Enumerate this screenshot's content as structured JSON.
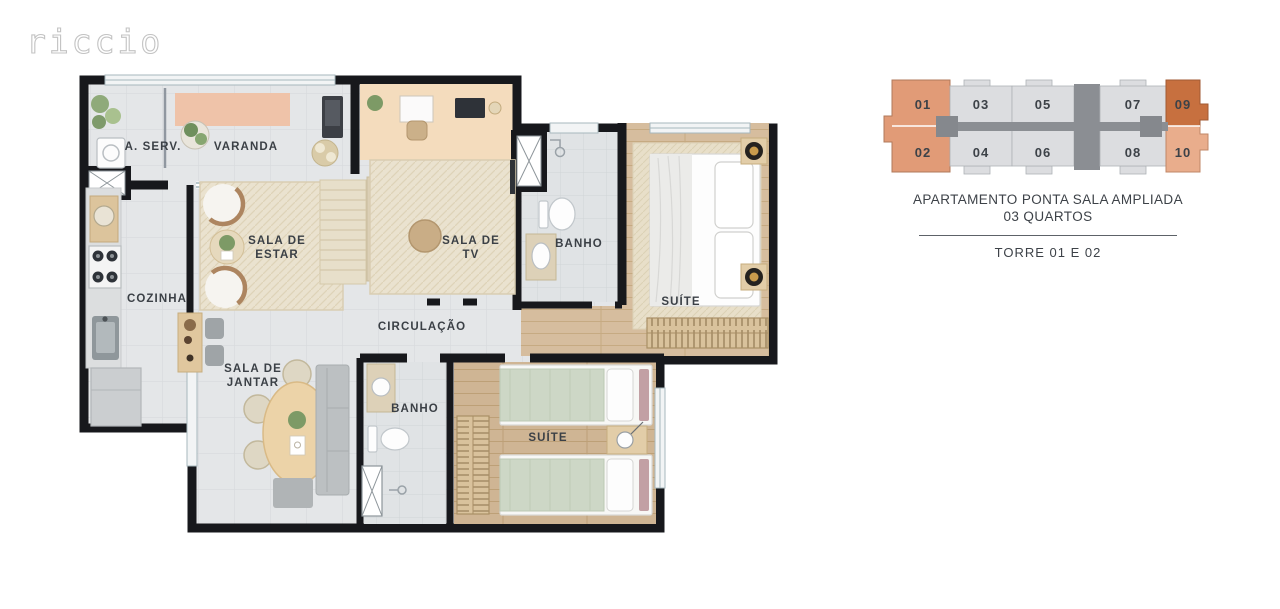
{
  "brand": {
    "logo": "riccio"
  },
  "floorplan": {
    "labels": {
      "a_serv": "A. SERV.",
      "varanda": "VARANDA",
      "sala_estar_l1": "SALA DE",
      "sala_estar_l2": "ESTAR",
      "sala_tv_l1": "SALA DE",
      "sala_tv_l2": "TV",
      "banho1": "BANHO",
      "suite1": "SUÍTE",
      "cozinha": "COZINHA",
      "circulacao": "CIRCULAÇÃO",
      "sala_jantar_l1": "SALA DE",
      "sala_jantar_l2": "JANTAR",
      "banho2": "BANHO",
      "suite2": "SUÍTE"
    }
  },
  "keyplan": {
    "units": [
      {
        "label": "01",
        "color": "#e19b77"
      },
      {
        "label": "02",
        "color": "#e19b77"
      },
      {
        "label": "03",
        "color": "#dcdde0"
      },
      {
        "label": "04",
        "color": "#dcdde0"
      },
      {
        "label": "05",
        "color": "#dcdde0"
      },
      {
        "label": "06",
        "color": "#dcdde0"
      },
      {
        "label": "07",
        "color": "#dcdde0"
      },
      {
        "label": "08",
        "color": "#dcdde0"
      },
      {
        "label": "09",
        "color": "#c7703f"
      },
      {
        "label": "10",
        "color": "#e9ad8c"
      }
    ],
    "caption_line1": "APARTAMENTO PONTA SALA AMPLIADA",
    "caption_line2": "03 QUARTOS",
    "tower": "TORRE 01 E 02"
  }
}
